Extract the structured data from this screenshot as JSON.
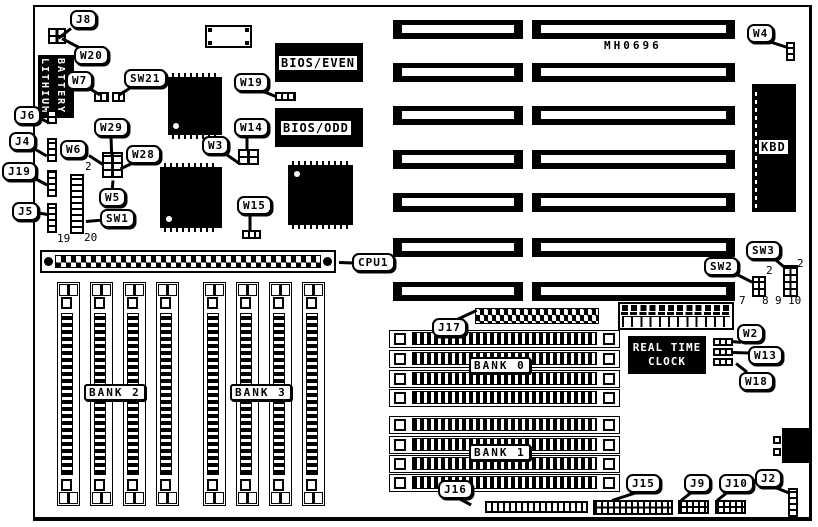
{
  "board": {
    "id_code": "MH0696"
  },
  "callouts": {
    "j8": "J8",
    "w20": "W20",
    "w7": "W7",
    "sw21": "SW21",
    "j6": "J6",
    "j4": "J4",
    "j19": "J19",
    "j5": "J5",
    "w29": "W29",
    "w6": "W6",
    "w28": "W28",
    "w5": "W5",
    "sw1": "SW1",
    "w19": "W19",
    "w14": "W14",
    "w3": "W3",
    "w15": "W15",
    "w4": "W4",
    "cpu1": "CPU1",
    "sw2": "SW2",
    "sw3": "SW3",
    "j17": "J17",
    "w2": "W2",
    "w13": "W13",
    "w18": "W18",
    "j16": "J16",
    "j15": "J15",
    "j9": "J9",
    "j10": "J10",
    "j2": "J2"
  },
  "chips": {
    "battery_line1": "LITHIUM",
    "battery_line2": "BATTERY",
    "bios_even": "BIOS/EVEN",
    "bios_odd": "BIOS/ODD",
    "kbd": "KBD",
    "rtc_line1": "REAL TIME",
    "rtc_line2": "CLOCK"
  },
  "banks": {
    "bank0": "BANK 0",
    "bank1": "BANK 1",
    "bank2": "BANK 2",
    "bank3": "BANK 3"
  },
  "numbers": {
    "w6_pin2": "2",
    "sw1_pin19": "19",
    "sw1_pin20": "20",
    "sw2_pin2": "2",
    "sw2_pin7": "7",
    "sw2_pin8": "8",
    "sw3_pin2": "2",
    "sw3_pin9": "9",
    "sw3_pin10": "10"
  },
  "colors": {
    "ink": "#000000",
    "paper": "#ffffff"
  }
}
